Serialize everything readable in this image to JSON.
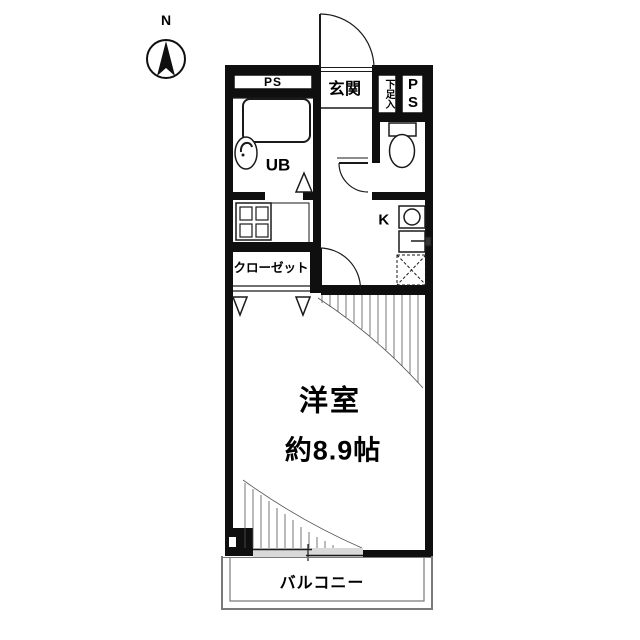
{
  "compass": {
    "north_label": "N"
  },
  "labels": {
    "ps_top": "PS",
    "entrance": "玄関",
    "shoe_cabinet": "下足入",
    "pipe_shaft_p": "P",
    "pipe_shaft_s": "S",
    "unit_bath": "UB",
    "kitchen": "K",
    "closet": "クローゼット",
    "main_room_name": "洋室",
    "main_room_size": "約8.9帖",
    "balcony": "バルコニー"
  },
  "colors": {
    "wall": "#0f0f0f",
    "line": "#1a1a1a",
    "balcony_line": "#7a7a7a",
    "window_glass": "#d9d9d9"
  }
}
